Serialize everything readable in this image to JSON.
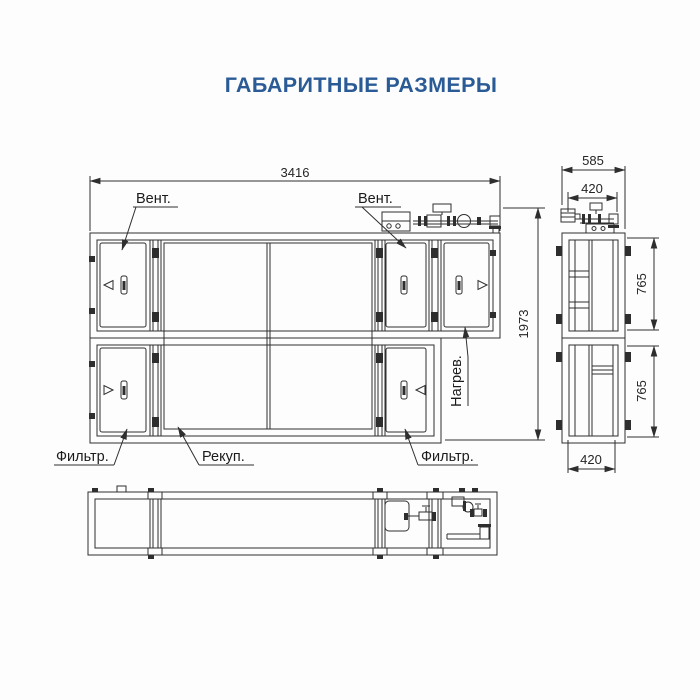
{
  "title": {
    "text": "ГАБАРИТНЫЕ РАЗМЕРЫ",
    "color": "#2b5b96"
  },
  "drawing": {
    "background": "#fdfdfd",
    "line_color": "#2e2e2e",
    "front_view": {
      "dim_width": "3416",
      "dim_height": "1973",
      "labels": {
        "fan_left": "Вент.",
        "fan_right": "Вент.",
        "filter_left": "Фильтр.",
        "filter_right": "Фильтр.",
        "recuperator": "Рекуп.",
        "heater": "Нагрев."
      }
    },
    "side_view": {
      "dim_depth": "585",
      "dim_top_width": "420",
      "dim_upper_height": "765",
      "dim_lower_height": "765",
      "dim_bottom_width": "420"
    }
  }
}
